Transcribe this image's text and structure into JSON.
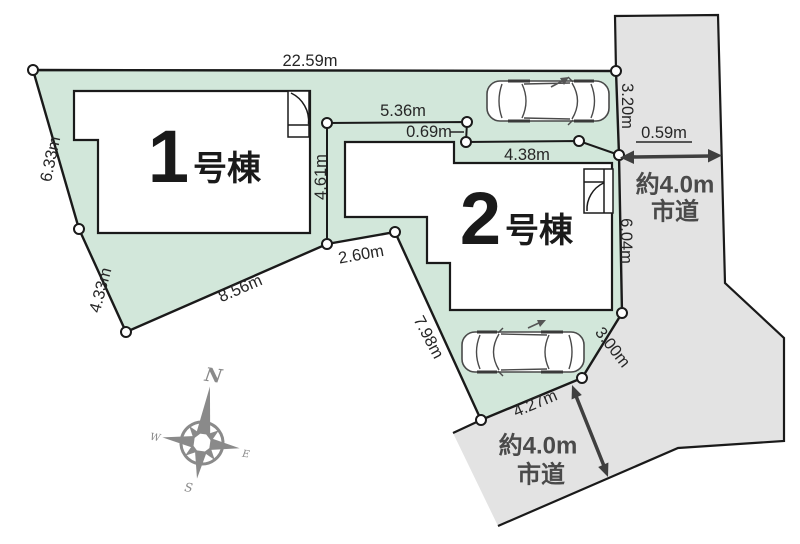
{
  "site_plan": {
    "buildings": [
      {
        "number": "1",
        "suffix": "号棟"
      },
      {
        "number": "2",
        "suffix": "号棟"
      }
    ],
    "dimensions": {
      "top": "22.59m",
      "left_upper": "6.33m",
      "left_lower": "4.33m",
      "bottom_left": "8.56m",
      "mid_edge": "2.60m",
      "lot2_left": "7.98m",
      "divider_vertical": "4.61m",
      "divider_top": "5.36m",
      "divider_step": "0.69m",
      "divider_right": "4.38m",
      "right_upper": "3.20m",
      "right_offset": "0.59m",
      "right_mid": "6.04m",
      "corner_diagonal": "3.00m",
      "bottom_edge": "4.27m"
    },
    "roads": {
      "right": {
        "line1": "約4.0m",
        "line2": "市道"
      },
      "bottom": {
        "line1": "約4.0m",
        "line2": "市道"
      }
    },
    "compass": {
      "n": "N",
      "w": "W",
      "e": "E",
      "s": "S"
    },
    "colors": {
      "lot_fill": "#d2e7da",
      "road_fill": "#e3e3e3",
      "outline": "#1a1a1a",
      "dimension_text": "#262626",
      "road_text": "#4a4a4a",
      "compass": "#8a8a8a"
    }
  }
}
